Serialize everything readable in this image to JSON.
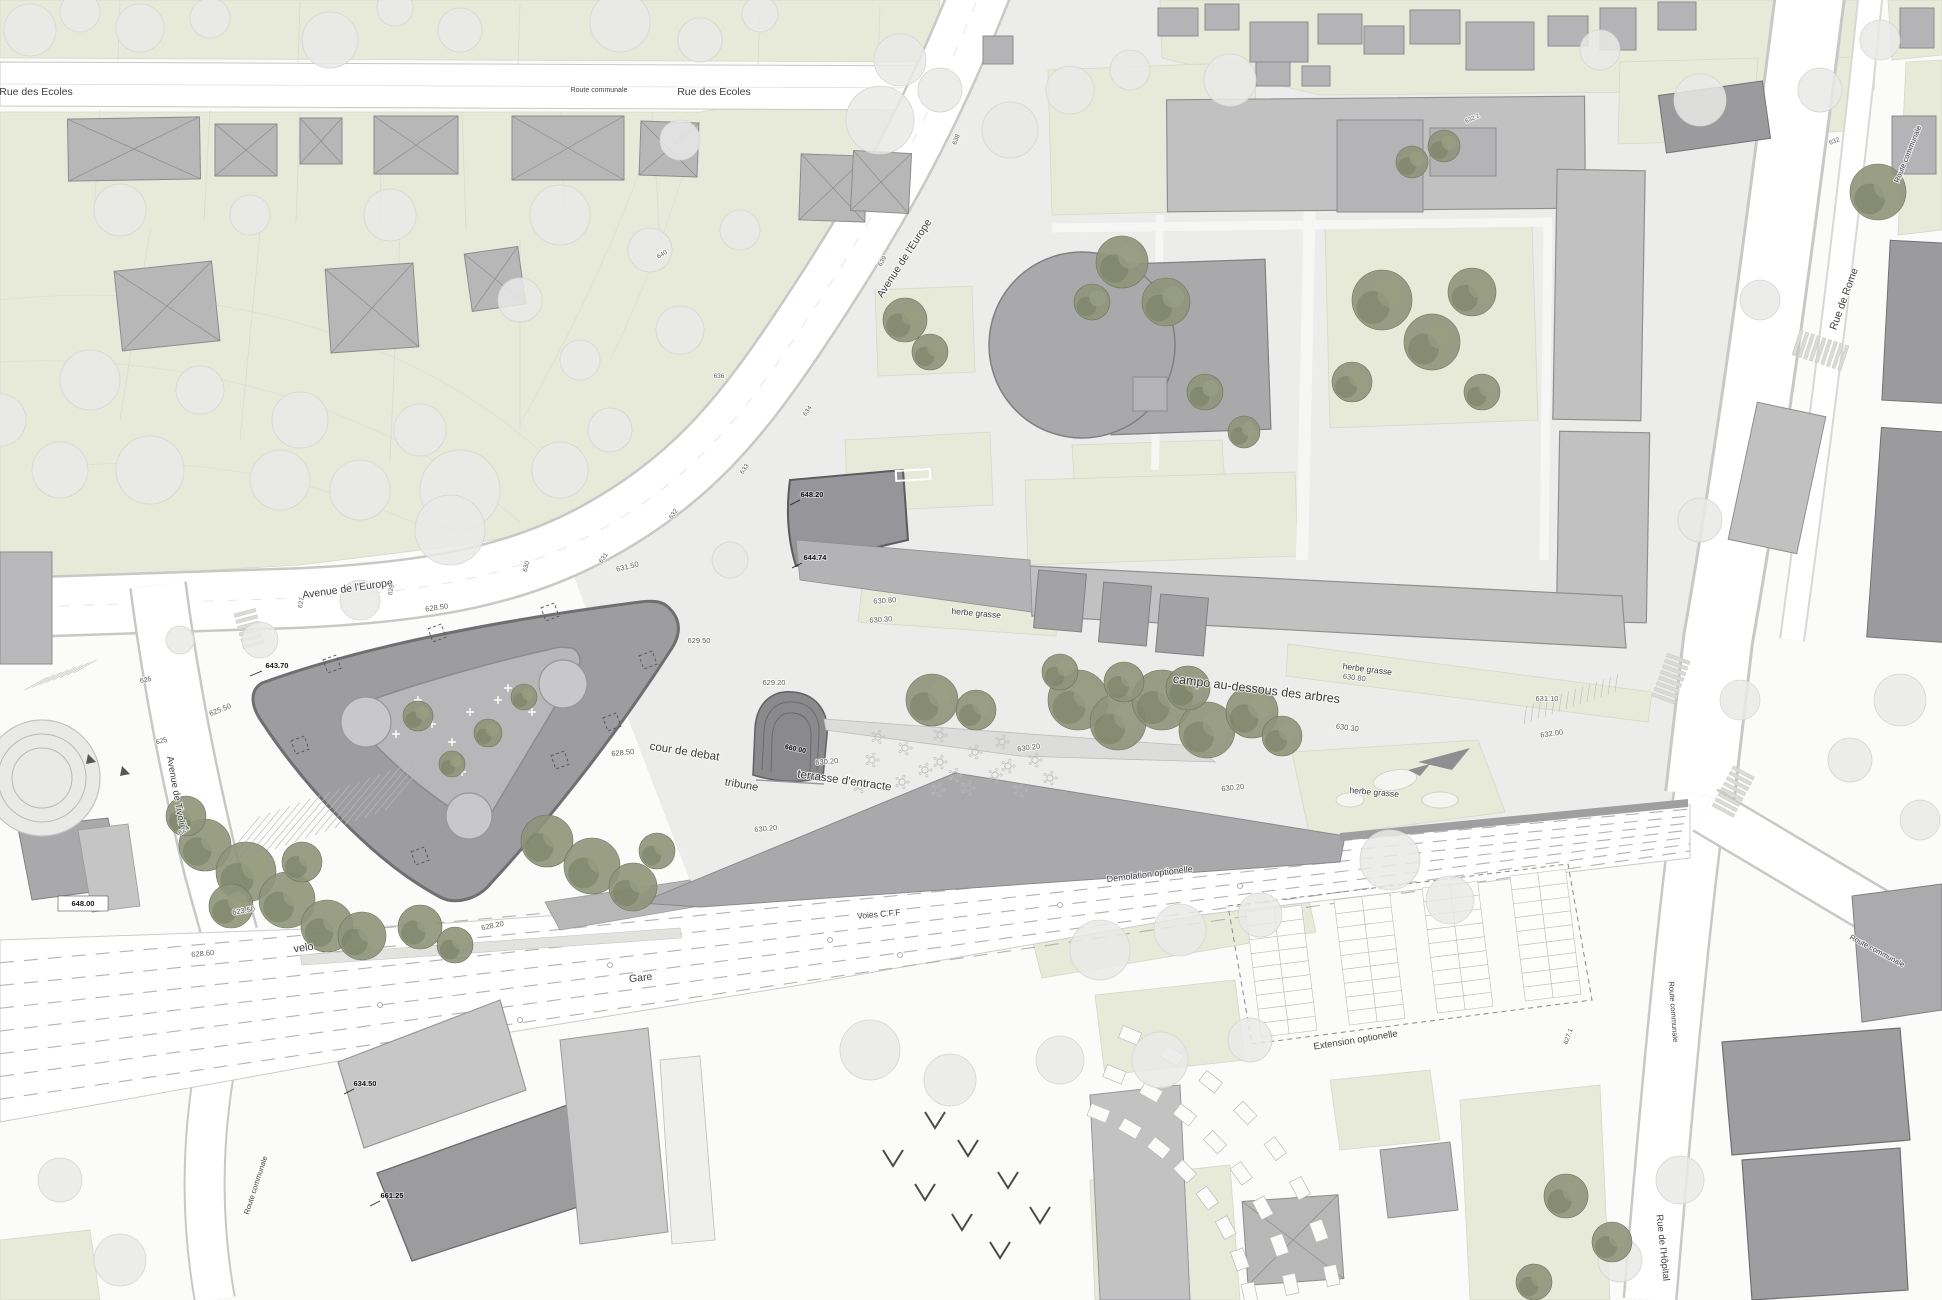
{
  "map": {
    "type": "architectural site plan",
    "colors": {
      "paper": "#fbfbfa",
      "parcel_green": "#e7e9d9",
      "campus_ground": "#ececea",
      "road_white": "#ffffff",
      "road_edge": "#c8c8c5",
      "plaza_gray": "#9d9da0",
      "plaza_inner": "#b7b7b9",
      "building_gray": "#c1c1c2",
      "building_dark": "#9b9b9d",
      "tree_olive": "#8f937a",
      "tree_light": "#eaeae8",
      "rail_line": "#b2b2b0",
      "label_road": "#3f3f3f",
      "label_elevation": "#5f5f5f",
      "label_spot": "#141414"
    }
  },
  "labels": [
    {
      "name": "rue-des-ecoles-1",
      "text": "Rue des Ecoles",
      "x": 36,
      "y": 95,
      "rot": 0,
      "size": 10.5,
      "cls": "road"
    },
    {
      "name": "route-communale-top",
      "text": "Route communale",
      "x": 599,
      "y": 92,
      "rot": 0,
      "size": 7,
      "cls": "road"
    },
    {
      "name": "rue-des-ecoles-2",
      "text": "Rue des Ecoles",
      "x": 714,
      "y": 95,
      "rot": 0,
      "size": 10.5,
      "cls": "road"
    },
    {
      "name": "avenue-de-l-europe-diag",
      "text": "Avenue de l'Europe",
      "x": 907,
      "y": 260,
      "rot": -57,
      "size": 10.5,
      "cls": "road"
    },
    {
      "name": "avenue-de-l-europe-left",
      "text": "Avenue de l'Europe",
      "x": 348,
      "y": 592,
      "rot": -8,
      "size": 10.5,
      "cls": "road"
    },
    {
      "name": "avenue-de-tivoli",
      "text": "Avenue de Tivoli",
      "x": 173,
      "y": 791,
      "rot": 80,
      "size": 9.5,
      "cls": "road"
    },
    {
      "name": "rue-de-rome",
      "text": "Rue de Rome",
      "x": 1847,
      "y": 300,
      "rot": -70,
      "size": 10.5,
      "cls": "road"
    },
    {
      "name": "route-communale-ne",
      "text": "Route communale",
      "x": 1910,
      "y": 155,
      "rot": -68,
      "size": 7.5,
      "cls": "road"
    },
    {
      "name": "route-communale-se",
      "text": "Route communale",
      "x": 1671,
      "y": 1012,
      "rot": 86,
      "size": 7.5,
      "cls": "road"
    },
    {
      "name": "route-communale-e",
      "text": "Route communale",
      "x": 1876,
      "y": 953,
      "rot": 28,
      "size": 7.5,
      "cls": "road"
    },
    {
      "name": "rue-de-l-hopital",
      "text": "Rue de l'Hôpital",
      "x": 1660,
      "y": 1248,
      "rot": 84,
      "size": 9.5,
      "cls": "road"
    },
    {
      "name": "route-communale-sw",
      "text": "Route communale",
      "x": 258,
      "y": 1186,
      "rot": -72,
      "size": 7.5,
      "cls": "road"
    },
    {
      "name": "gare",
      "text": "Gare",
      "x": 641,
      "y": 981,
      "rot": -6,
      "size": 10.5,
      "cls": "road"
    },
    {
      "name": "voies-cff",
      "text": "Voies C.F.F",
      "x": 879,
      "y": 917,
      "rot": -5,
      "size": 8.5,
      "cls": "road"
    },
    {
      "name": "demolation-optionelle",
      "text": "Demolation optionelle",
      "x": 1150,
      "y": 877,
      "rot": -7,
      "size": 9,
      "cls": "road"
    },
    {
      "name": "extension-optionelle",
      "text": "Extension optionelle",
      "x": 1356,
      "y": 1043,
      "rot": -9,
      "size": 9.5,
      "cls": "road"
    },
    {
      "name": "velo",
      "text": "velo",
      "x": 304,
      "y": 951,
      "rot": -8,
      "size": 11,
      "cls": "prog"
    },
    {
      "name": "cour-de-debat",
      "text": "cour de debat",
      "x": 684,
      "y": 755,
      "rot": 9,
      "size": 11.5,
      "cls": "prog"
    },
    {
      "name": "tribune",
      "text": "tribune",
      "x": 741,
      "y": 788,
      "rot": 10,
      "size": 11,
      "cls": "prog"
    },
    {
      "name": "terrasse-d-entracte",
      "text": "terrasse d'entracte",
      "x": 844,
      "y": 784,
      "rot": 8,
      "size": 11.5,
      "cls": "prog"
    },
    {
      "name": "campo-au-dessous-des-arbres",
      "text": "campo au-dessous des arbres",
      "x": 1256,
      "y": 693,
      "rot": 7,
      "size": 12.5,
      "cls": "prog"
    },
    {
      "name": "herbe-grasse-1",
      "text": "herbe grasse",
      "x": 976,
      "y": 616,
      "rot": 5,
      "size": 8.5,
      "cls": "prog"
    },
    {
      "name": "herbe-grasse-2",
      "text": "herbe grasse",
      "x": 1367,
      "y": 672,
      "rot": 7,
      "size": 8.5,
      "cls": "prog"
    },
    {
      "name": "herbe-grasse-3",
      "text": "herbe grasse",
      "x": 1374,
      "y": 795,
      "rot": 5,
      "size": 8.5,
      "cls": "prog"
    },
    {
      "name": "elev-628-50-a",
      "text": "628.50",
      "x": 437,
      "y": 610,
      "rot": -8,
      "size": 7.5,
      "cls": "elev"
    },
    {
      "name": "elev-631-50",
      "text": "631.50",
      "x": 628,
      "y": 569,
      "rot": -14,
      "size": 7.5,
      "cls": "elev"
    },
    {
      "name": "elev-625-50",
      "text": "625.50",
      "x": 221,
      "y": 712,
      "rot": -22,
      "size": 7.5,
      "cls": "elev"
    },
    {
      "name": "elev-626",
      "text": "626",
      "x": 146,
      "y": 682,
      "rot": -10,
      "size": 7,
      "cls": "elev"
    },
    {
      "name": "elev-625",
      "text": "625",
      "x": 162,
      "y": 743,
      "rot": -14,
      "size": 7,
      "cls": "elev"
    },
    {
      "name": "elev-624",
      "text": "624",
      "x": 185,
      "y": 832,
      "rot": -35,
      "size": 7,
      "cls": "elev"
    },
    {
      "name": "elev-623-50",
      "text": "623.50",
      "x": 244,
      "y": 913,
      "rot": -10,
      "size": 7.5,
      "cls": "elev"
    },
    {
      "name": "elev-628-60",
      "text": "628.60",
      "x": 203,
      "y": 956,
      "rot": -5,
      "size": 7.5,
      "cls": "elev"
    },
    {
      "name": "elev-628-20",
      "text": "628.20",
      "x": 493,
      "y": 928,
      "rot": -12,
      "size": 7.5,
      "cls": "elev"
    },
    {
      "name": "elev-628-50-b",
      "text": "628.50",
      "x": 623,
      "y": 755,
      "rot": -6,
      "size": 7.5,
      "cls": "elev"
    },
    {
      "name": "elev-629-50",
      "text": "629.50",
      "x": 699,
      "y": 643,
      "rot": 0,
      "size": 7.5,
      "cls": "elev"
    },
    {
      "name": "elev-629-20",
      "text": "629.20",
      "x": 774,
      "y": 685,
      "rot": 0,
      "size": 7.5,
      "cls": "elev"
    },
    {
      "name": "elev-630-20-a",
      "text": "630.20",
      "x": 827,
      "y": 764,
      "rot": -5,
      "size": 7.5,
      "cls": "elev"
    },
    {
      "name": "elev-630-20-b",
      "text": "630.20",
      "x": 1029,
      "y": 750,
      "rot": -8,
      "size": 7.5,
      "cls": "elev"
    },
    {
      "name": "elev-630-20-c",
      "text": "630.20",
      "x": 766,
      "y": 831,
      "rot": -5,
      "size": 7.5,
      "cls": "elev"
    },
    {
      "name": "elev-630-20-d",
      "text": "630.20",
      "x": 1233,
      "y": 790,
      "rot": -6,
      "size": 7.5,
      "cls": "elev"
    },
    {
      "name": "elev-630-80-a",
      "text": "630.80",
      "x": 885,
      "y": 603,
      "rot": -4,
      "size": 7.5,
      "cls": "elev"
    },
    {
      "name": "elev-630-30-a",
      "text": "630.30",
      "x": 881,
      "y": 622,
      "rot": -4,
      "size": 7.5,
      "cls": "elev"
    },
    {
      "name": "elev-630-80-b",
      "text": "630.80",
      "x": 1354,
      "y": 680,
      "rot": 7,
      "size": 7.5,
      "cls": "elev"
    },
    {
      "name": "elev-630-30-b",
      "text": "630.30",
      "x": 1347,
      "y": 730,
      "rot": 7,
      "size": 7.5,
      "cls": "elev"
    },
    {
      "name": "elev-631-10",
      "text": "631.10",
      "x": 1547,
      "y": 701,
      "rot": 0,
      "size": 7.5,
      "cls": "elev"
    },
    {
      "name": "elev-632-00",
      "text": "632.00",
      "x": 1552,
      "y": 736,
      "rot": -8,
      "size": 7.5,
      "cls": "elev"
    },
    {
      "name": "elev-627",
      "text": "627",
      "x": 303,
      "y": 603,
      "rot": -80,
      "size": 6.5,
      "cls": "elev"
    },
    {
      "name": "elev-629",
      "text": "629",
      "x": 393,
      "y": 590,
      "rot": -80,
      "size": 6.5,
      "cls": "elev"
    },
    {
      "name": "elev-630",
      "text": "630",
      "x": 528,
      "y": 567,
      "rot": -75,
      "size": 6.5,
      "cls": "elev"
    },
    {
      "name": "elev-631",
      "text": "631",
      "x": 605,
      "y": 559,
      "rot": -55,
      "size": 6.5,
      "cls": "elev"
    },
    {
      "name": "elev-632",
      "text": "632",
      "x": 675,
      "y": 515,
      "rot": -55,
      "size": 6.5,
      "cls": "elev"
    },
    {
      "name": "elev-633",
      "text": "633",
      "x": 746,
      "y": 470,
      "rot": -55,
      "size": 6.5,
      "cls": "elev"
    },
    {
      "name": "elev-634",
      "text": "634",
      "x": 809,
      "y": 412,
      "rot": -55,
      "size": 6.5,
      "cls": "elev"
    },
    {
      "name": "elev-636",
      "text": "636",
      "x": 719,
      "y": 378,
      "rot": 0,
      "size": 6.5,
      "cls": "elev"
    },
    {
      "name": "elev-638",
      "text": "638",
      "x": 958,
      "y": 140,
      "rot": -70,
      "size": 6.5,
      "cls": "elev"
    },
    {
      "name": "elev-639",
      "text": "639",
      "x": 884,
      "y": 262,
      "rot": -60,
      "size": 6.5,
      "cls": "elev"
    },
    {
      "name": "elev-640",
      "text": "640",
      "x": 663,
      "y": 256,
      "rot": -30,
      "size": 6.5,
      "cls": "elev"
    },
    {
      "name": "elev-632-ne",
      "text": "632",
      "x": 1835,
      "y": 143,
      "rot": -20,
      "size": 6.5,
      "cls": "elev"
    },
    {
      "name": "elev-627-1",
      "text": "627.1",
      "x": 1570,
      "y": 1037,
      "rot": -70,
      "size": 6.5,
      "cls": "elev"
    },
    {
      "name": "elev-632-2",
      "text": "632.2",
      "x": 1473,
      "y": 120,
      "rot": -25,
      "size": 6,
      "cls": "elev"
    },
    {
      "name": "spot-643-70",
      "text": "643.70",
      "x": 277,
      "y": 668,
      "rot": 0,
      "size": 7.5,
      "cls": "spot"
    },
    {
      "name": "spot-648-20",
      "text": "648.20",
      "x": 812,
      "y": 497,
      "rot": 0,
      "size": 7.5,
      "cls": "spot"
    },
    {
      "name": "spot-644-74",
      "text": "644.74",
      "x": 815,
      "y": 560,
      "rot": 0,
      "size": 7.5,
      "cls": "spot"
    },
    {
      "name": "spot-648-00",
      "text": "648.00",
      "x": 83,
      "y": 906,
      "rot": 0,
      "size": 7.5,
      "cls": "spot"
    },
    {
      "name": "spot-660-00",
      "text": "660.00",
      "x": 795,
      "y": 751,
      "rot": 12,
      "size": 7,
      "cls": "spot"
    },
    {
      "name": "spot-634-50",
      "text": "634.50",
      "x": 365,
      "y": 1086,
      "rot": 0,
      "size": 7.5,
      "cls": "spot"
    },
    {
      "name": "spot-661-25",
      "text": "661.25",
      "x": 392,
      "y": 1198,
      "rot": 0,
      "size": 7.5,
      "cls": "spot"
    }
  ]
}
